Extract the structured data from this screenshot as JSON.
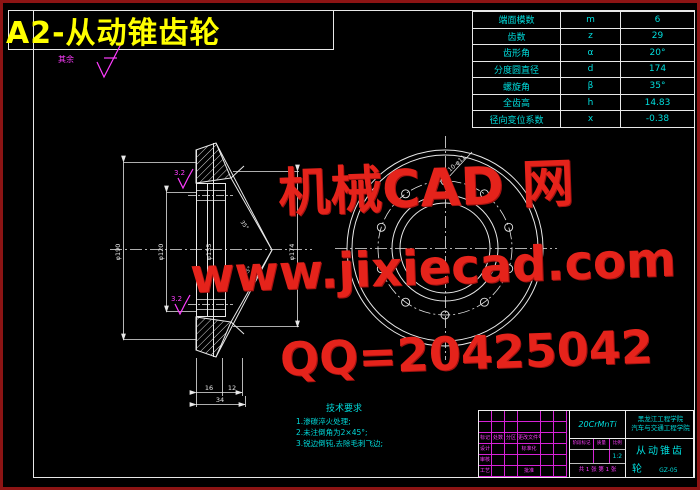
{
  "title": "A2-从动锥齿轮",
  "surface_default_label": "其余",
  "param_table": {
    "rows": [
      {
        "label": "端面模数",
        "symbol": "m",
        "value": "6"
      },
      {
        "label": "齿数",
        "symbol": "z",
        "value": "29"
      },
      {
        "label": "齿形角",
        "symbol": "α",
        "value": "20°"
      },
      {
        "label": "分度圆直径",
        "symbol": "d",
        "value": "174"
      },
      {
        "label": "螺旋角",
        "symbol": "β",
        "value": "35°"
      },
      {
        "label": "全齿高",
        "symbol": "h",
        "value": "14.83"
      },
      {
        "label": "径向变位系数",
        "symbol": "x",
        "value": "-0.38"
      }
    ]
  },
  "watermark": {
    "color": "#e5231b",
    "line1": "机械CAD 网",
    "line2": "www.jixiecad.com",
    "line3": "QQ=20425042"
  },
  "tech_notes": {
    "title": "技术要求",
    "items": [
      "1.渗碳淬火处理;",
      "2.未注倒角为2×45°;",
      "3.锐边倒钝,去除毛刺飞边;"
    ]
  },
  "dimensions": {
    "flange_od": "φ190",
    "bore": "φ120",
    "hub": "φ135",
    "gear_od": "φ174",
    "w16": "16",
    "w12": "12",
    "w34": "34",
    "angle1": "35°",
    "angle2": "45°",
    "holes_note": "10-φ11",
    "rough1": "3.2",
    "rough2": "3.2"
  },
  "title_block": {
    "material": "20CrMnTi",
    "school_line1": "黑龙江工程学院",
    "school_line2": "汽车与交通工程学院",
    "part_name_line1": "从动锥齿",
    "part_name_line2": "轮",
    "drawing_no": "GZ-05",
    "labels": {
      "mark": "标记",
      "count": "处数",
      "zone": "分区",
      "change_file": "更改文件号",
      "design": "设计",
      "standard": "标准化",
      "audit": "审核",
      "process": "工艺",
      "approve": "批准",
      "stage": "阶段标记",
      "weight": "质量",
      "scale": "比例",
      "scale_value": "1:2",
      "sheets": "共 1 张",
      "sheet_no": "第 1 张"
    }
  }
}
